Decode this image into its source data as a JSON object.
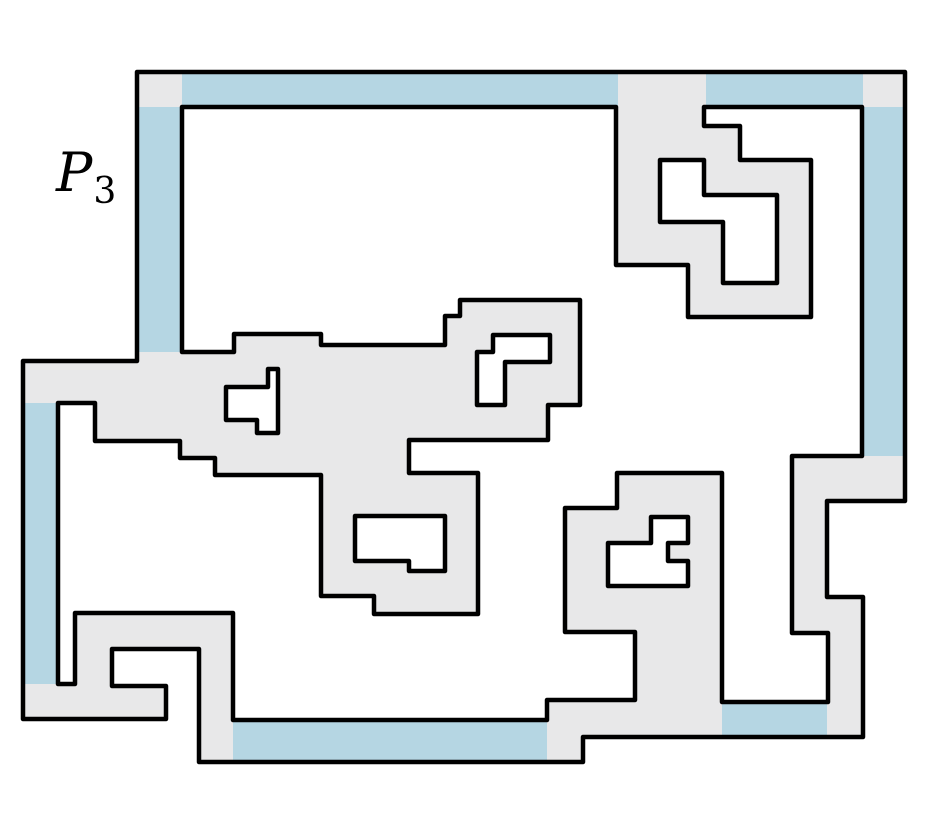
{
  "title": "Orthogonal polygon diagram",
  "label": {
    "main": "P",
    "sub": "3"
  },
  "figure": {
    "canvas": {
      "width": 936,
      "height": 820
    },
    "colors": {
      "background": "#ffffff",
      "interior": "#e8e8e9",
      "highlight": "#b5d6e3",
      "outline": "#000000"
    },
    "stroke_width": 4.5,
    "outer_boundary": [
      [
        137,
        72
      ],
      [
        905,
        72
      ],
      [
        905,
        501
      ],
      [
        827,
        501
      ],
      [
        827,
        597
      ],
      [
        863,
        597
      ],
      [
        863,
        737
      ],
      [
        583,
        737
      ],
      [
        583,
        762
      ],
      [
        199,
        762
      ],
      [
        199,
        649
      ],
      [
        112,
        649
      ],
      [
        112,
        686
      ],
      [
        166,
        686
      ],
      [
        166,
        719
      ],
      [
        23,
        719
      ],
      [
        23,
        361
      ],
      [
        137,
        361
      ]
    ],
    "holes": [
      {
        "name": "main-wraparound-room",
        "points": [
          [
            182,
            107
          ],
          [
            616,
            107
          ],
          [
            616,
            265
          ],
          [
            688,
            265
          ],
          [
            688,
            317
          ],
          [
            811,
            317
          ],
          [
            811,
            160
          ],
          [
            740,
            160
          ],
          [
            740,
            126
          ],
          [
            704,
            126
          ],
          [
            704,
            107
          ],
          [
            862,
            107
          ],
          [
            862,
            456
          ],
          [
            792,
            456
          ],
          [
            792,
            633
          ],
          [
            828,
            633
          ],
          [
            828,
            702
          ],
          [
            722,
            702
          ],
          [
            722,
            473
          ],
          [
            617,
            473
          ],
          [
            617,
            508
          ],
          [
            565,
            508
          ],
          [
            565,
            632
          ],
          [
            635,
            632
          ],
          [
            635,
            700
          ],
          [
            547,
            700
          ],
          [
            547,
            720
          ],
          [
            233,
            720
          ],
          [
            233,
            613
          ],
          [
            75,
            613
          ],
          [
            75,
            684
          ],
          [
            58,
            684
          ],
          [
            58,
            403
          ],
          [
            95,
            403
          ],
          [
            95,
            441
          ],
          [
            180,
            441
          ],
          [
            180,
            458
          ],
          [
            215,
            458
          ],
          [
            215,
            475
          ],
          [
            321,
            475
          ],
          [
            321,
            596
          ],
          [
            374,
            596
          ],
          [
            374,
            614
          ],
          [
            478,
            614
          ],
          [
            478,
            473
          ],
          [
            409,
            473
          ],
          [
            409,
            440
          ],
          [
            548,
            440
          ],
          [
            548,
            405
          ],
          [
            580,
            405
          ],
          [
            580,
            300
          ],
          [
            460,
            300
          ],
          [
            460,
            316
          ],
          [
            445,
            316
          ],
          [
            445,
            345
          ],
          [
            321,
            345
          ],
          [
            321,
            334
          ],
          [
            234,
            334
          ],
          [
            234,
            352
          ],
          [
            182,
            352
          ]
        ]
      },
      {
        "name": "z-shaped-hole-top-right",
        "points": [
          [
            660,
            160
          ],
          [
            704,
            160
          ],
          [
            704,
            195
          ],
          [
            777,
            195
          ],
          [
            777,
            283
          ],
          [
            723,
            283
          ],
          [
            723,
            222
          ],
          [
            660,
            222
          ]
        ]
      },
      {
        "name": "flag-shaped-hole-middle-left",
        "points": [
          [
            268,
            369
          ],
          [
            278,
            369
          ],
          [
            278,
            433
          ],
          [
            257,
            433
          ],
          [
            257,
            420
          ],
          [
            226,
            420
          ],
          [
            226,
            387
          ],
          [
            268,
            387
          ]
        ]
      },
      {
        "name": "gamma-shaped-hole-middle",
        "points": [
          [
            493,
            335
          ],
          [
            550,
            335
          ],
          [
            550,
            362
          ],
          [
            505,
            362
          ],
          [
            505,
            405
          ],
          [
            477,
            405
          ],
          [
            477,
            352
          ],
          [
            493,
            352
          ]
        ]
      },
      {
        "name": "notched-rect-hole-bottom-middle",
        "points": [
          [
            355,
            516
          ],
          [
            445,
            516
          ],
          [
            445,
            571
          ],
          [
            409,
            571
          ],
          [
            409,
            561
          ],
          [
            355,
            561
          ]
        ]
      },
      {
        "name": "notched-hole-bottom-right",
        "points": [
          [
            651,
            517
          ],
          [
            688,
            517
          ],
          [
            688,
            543
          ],
          [
            668,
            543
          ],
          [
            668,
            561
          ],
          [
            688,
            561
          ],
          [
            688,
            586
          ],
          [
            608,
            586
          ],
          [
            608,
            543
          ],
          [
            651,
            543
          ]
        ]
      }
    ],
    "highlighted_edges": [
      {
        "name": "top-edge-left-segment",
        "x": 182,
        "y": 72,
        "width": 436,
        "height": 35
      },
      {
        "name": "top-edge-right-segment",
        "x": 706,
        "y": 72,
        "width": 157,
        "height": 35
      },
      {
        "name": "right-edge-segment",
        "x": 862,
        "y": 107,
        "width": 43,
        "height": 349
      },
      {
        "name": "left-edge-upper-segment",
        "x": 137,
        "y": 107,
        "width": 45,
        "height": 245
      },
      {
        "name": "left-edge-lower-segment",
        "x": 23,
        "y": 403,
        "width": 35,
        "height": 281
      },
      {
        "name": "bottom-edge-segment",
        "x": 233,
        "y": 721,
        "width": 314,
        "height": 41
      },
      {
        "name": "bottom-right-edge-segment",
        "x": 722,
        "y": 702,
        "width": 105,
        "height": 35
      }
    ]
  }
}
